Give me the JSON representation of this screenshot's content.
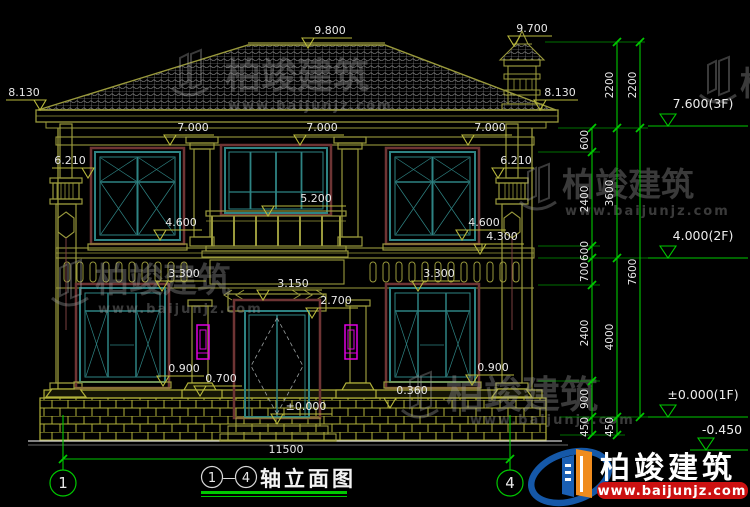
{
  "watermark": {
    "brand": "柏竣建筑",
    "url": "www.baijunjz.com"
  },
  "logo": {
    "brand": "柏竣建筑",
    "url": "www.baijunjz.com"
  },
  "title": {
    "axis_start": "1",
    "axis_end": "4",
    "dash": "—",
    "text": "轴立面图"
  },
  "axis_bubbles": {
    "left": "1",
    "right": "4"
  },
  "overall_width_dim": "11500",
  "elevations": {
    "ridge": "9.800",
    "chimney_top": "9.700",
    "eave_left": "8.130",
    "eave_right": "8.130",
    "cornice_left": "7.000",
    "cornice_center": "7.000",
    "cornice_right": "7.000",
    "capital_left": "6.210",
    "capital_right": "6.210",
    "balcony_rail": "5.200",
    "band_top_left": "4.600",
    "band_top_right": "4.600",
    "balcony_floor_right": "4.300",
    "window_head_left": "3.300",
    "window_head_right": "3.300",
    "porch_band": "3.150",
    "door_head": "2.700",
    "sill_left": "0.900",
    "sill_right": "0.900",
    "plinth_cap": "0.700",
    "plinth_right": "0.360",
    "entry": "±0.000"
  },
  "floor_levels": {
    "f3": "7.600(3F)",
    "f2": "4.000(2F)",
    "f1": "±0.000(1F)",
    "footing": "-0.450"
  },
  "dim_chains": {
    "inner": [
      "600",
      "2400",
      "600",
      "700",
      "2400",
      "900",
      "450"
    ],
    "middle": [
      "2200",
      "3600",
      "4000",
      "450"
    ],
    "outer": [
      "2200",
      "7600"
    ]
  },
  "colors": {
    "background": "#000000",
    "drawing_line": "#9a9a3c",
    "dimension_green": "#00c800",
    "window_teal": "#2e8383",
    "trim_red": "#6e3434",
    "lamp_magenta": "#e000e0",
    "plinth_yellow": "#b2b23a",
    "text_white": "#e8e8e8",
    "logo_blue": "#1a5fb4",
    "logo_orange": "#f08c1e",
    "logo_red": "#cc1111",
    "watermark_gray": "#9a9a9a"
  }
}
